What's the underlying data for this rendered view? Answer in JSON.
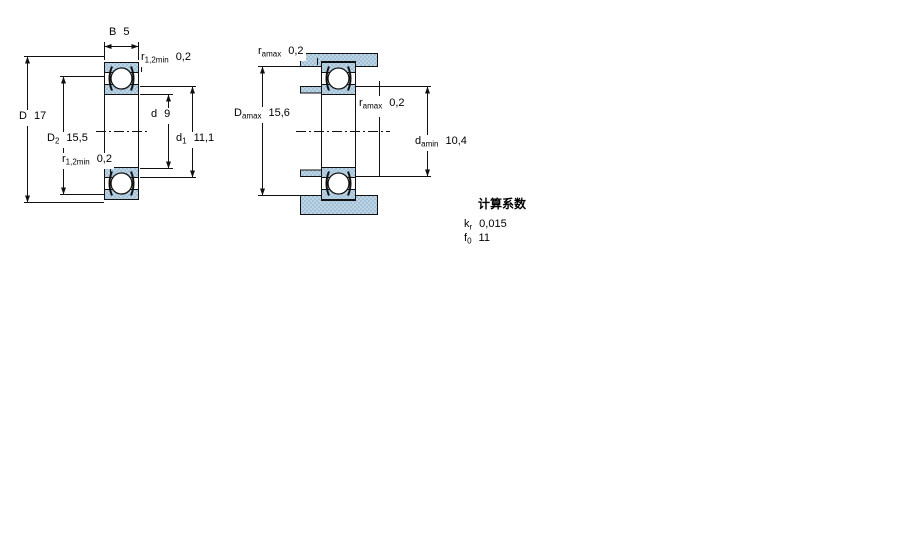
{
  "colors": {
    "section_fill_light": "#bdd4e4",
    "section_fill_dark": "#a3c2d8",
    "line": "#111111",
    "background": "#ffffff"
  },
  "views": {
    "left": {
      "title": "bearing-cross-section",
      "labels": {
        "width": {
          "base": "B",
          "value": "5"
        },
        "r_top": {
          "base": "r",
          "sub": "1,2min",
          "value": "0,2"
        },
        "outer_diameter": {
          "base": "D",
          "value": "17"
        },
        "recess_diameter": {
          "base": "D",
          "sub": "2",
          "value": "15,5"
        },
        "bore_diameter": {
          "base": "d",
          "value": "9"
        },
        "shoulder_diameter": {
          "base": "d",
          "sub": "1",
          "value": "11,1"
        },
        "r_mid": {
          "base": "r",
          "sub": "1,2min",
          "value": "0,2"
        }
      }
    },
    "right": {
      "title": "abutment-and-fillet-dimensions",
      "labels": {
        "ra_top": {
          "base": "r",
          "sub": "amax",
          "value": "0,2"
        },
        "housing_shoulder": {
          "base": "D",
          "sub": "amax",
          "value": "15,6"
        },
        "ra_mid": {
          "base": "r",
          "sub": "amax",
          "value": "0,2"
        },
        "shaft_shoulder": {
          "base": "d",
          "sub": "amin",
          "value": "10,4"
        }
      }
    }
  },
  "factors": {
    "title": "计算系数",
    "rows": [
      {
        "base": "k",
        "sub": "r",
        "value": "0,015"
      },
      {
        "base": "f",
        "sub": "0",
        "value": "11"
      }
    ]
  }
}
